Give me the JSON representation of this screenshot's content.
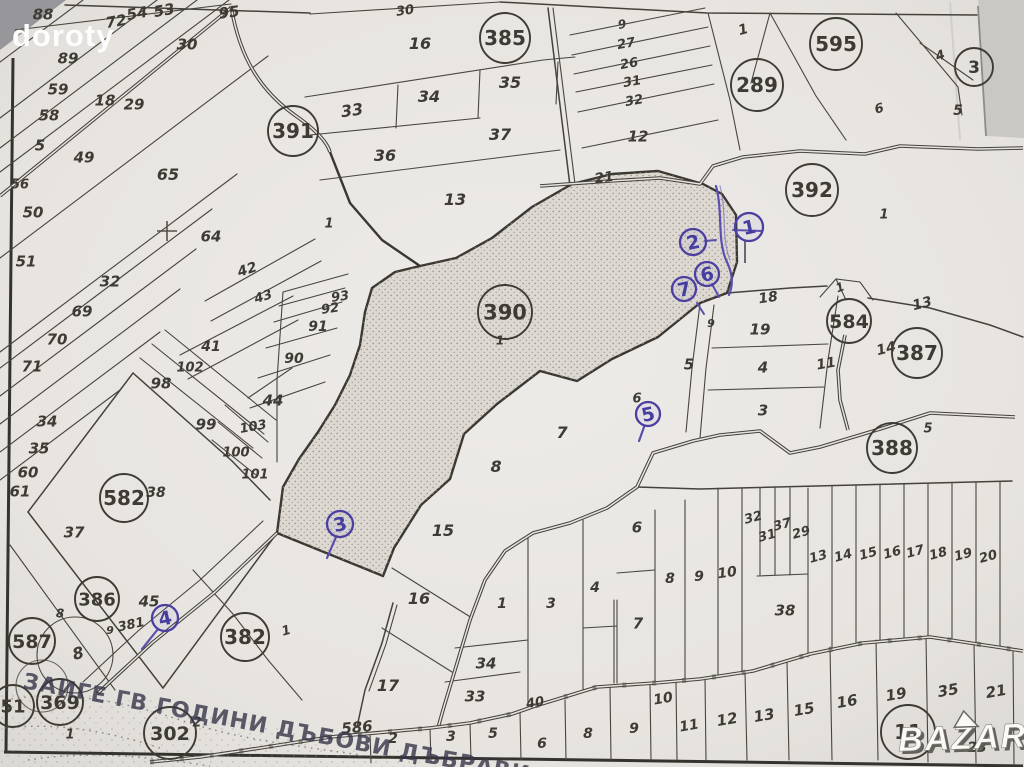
{
  "watermark": {
    "photographer": "doroty",
    "site": "BAZAR"
  },
  "handwriting": {
    "text": "ЗАИГЕ ГВ ГОДИНИ ДЪБОВИ ДЪБРАВИ"
  },
  "colors": {
    "paper": "#e9e6e2",
    "ink": "#3e3b34",
    "pen_blue": "#4c3f9f",
    "shade_fill": "#ddd9d2",
    "photo_gray": "#97969a"
  },
  "map_type": "cadastral-parcel-plan",
  "highlighted_parcel": "390",
  "pen_annotations": [
    "1",
    "2",
    "3",
    "4",
    "5",
    "6",
    "7"
  ],
  "labels": [
    {
      "t": "88",
      "x": 43,
      "y": 14,
      "k": "n"
    },
    {
      "t": "72",
      "x": 116,
      "y": 21,
      "k": "n",
      "rot": -10
    },
    {
      "t": "54",
      "x": 137,
      "y": 13,
      "k": "n",
      "rot": -10
    },
    {
      "t": "53",
      "x": 164,
      "y": 10,
      "k": "n",
      "rot": -10
    },
    {
      "t": "95",
      "x": 229,
      "y": 12,
      "k": "n",
      "rot": -8
    },
    {
      "t": "30",
      "x": 187,
      "y": 44,
      "k": "n"
    },
    {
      "t": "89",
      "x": 68,
      "y": 58,
      "k": "n"
    },
    {
      "t": "59",
      "x": 58,
      "y": 89,
      "k": "n"
    },
    {
      "t": "18",
      "x": 105,
      "y": 100,
      "k": "n"
    },
    {
      "t": "29",
      "x": 134,
      "y": 104,
      "k": "n"
    },
    {
      "t": "58",
      "x": 49,
      "y": 115,
      "k": "n"
    },
    {
      "t": "5",
      "x": 40,
      "y": 145,
      "k": "n"
    },
    {
      "t": "49",
      "x": 84,
      "y": 157,
      "k": "n"
    },
    {
      "t": "56",
      "x": 20,
      "y": 184,
      "k": "n",
      "fs": 13
    },
    {
      "t": "65",
      "x": 168,
      "y": 174,
      "k": "n",
      "fs": 16
    },
    {
      "t": "50",
      "x": 33,
      "y": 212,
      "k": "n"
    },
    {
      "t": "64",
      "x": 211,
      "y": 236,
      "k": "n"
    },
    {
      "t": "51",
      "x": 26,
      "y": 261,
      "k": "n"
    },
    {
      "t": "32",
      "x": 110,
      "y": 281,
      "k": "n"
    },
    {
      "t": "42",
      "x": 247,
      "y": 269,
      "k": "n",
      "rot": -18,
      "fs": 14
    },
    {
      "t": "43",
      "x": 263,
      "y": 296,
      "k": "n",
      "rot": -18,
      "fs": 13
    },
    {
      "t": "69",
      "x": 82,
      "y": 311,
      "k": "n"
    },
    {
      "t": "70",
      "x": 57,
      "y": 339,
      "k": "n"
    },
    {
      "t": "41",
      "x": 211,
      "y": 346,
      "k": "n",
      "fs": 14
    },
    {
      "t": "71",
      "x": 32,
      "y": 366,
      "k": "n"
    },
    {
      "t": "102",
      "x": 190,
      "y": 367,
      "k": "n",
      "fs": 13
    },
    {
      "t": "98",
      "x": 161,
      "y": 383,
      "k": "n"
    },
    {
      "t": "44",
      "x": 273,
      "y": 400,
      "k": "n"
    },
    {
      "t": "34",
      "x": 47,
      "y": 421,
      "k": "n"
    },
    {
      "t": "99",
      "x": 206,
      "y": 424,
      "k": "n"
    },
    {
      "t": "103",
      "x": 253,
      "y": 426,
      "k": "n",
      "rot": -10,
      "fs": 13
    },
    {
      "t": "35",
      "x": 39,
      "y": 448,
      "k": "n"
    },
    {
      "t": "100",
      "x": 236,
      "y": 452,
      "k": "n",
      "fs": 13
    },
    {
      "t": "60",
      "x": 28,
      "y": 472,
      "k": "n"
    },
    {
      "t": "101",
      "x": 255,
      "y": 474,
      "k": "n",
      "fs": 13
    },
    {
      "t": "61",
      "x": 20,
      "y": 491,
      "k": "n"
    },
    {
      "t": "582",
      "x": 124,
      "y": 498,
      "k": "c",
      "r": 24,
      "fs": 20
    },
    {
      "t": "38",
      "x": 156,
      "y": 492,
      "k": "n",
      "fs": 14
    },
    {
      "t": "37",
      "x": 74,
      "y": 532,
      "k": "n"
    },
    {
      "t": "386",
      "x": 97,
      "y": 599,
      "k": "c",
      "r": 22,
      "fs": 18
    },
    {
      "t": "45",
      "x": 149,
      "y": 601,
      "k": "n"
    },
    {
      "t": "8",
      "x": 60,
      "y": 613,
      "k": "n",
      "fs": 12
    },
    {
      "t": "381",
      "x": 131,
      "y": 624,
      "k": "n",
      "rot": -12,
      "fs": 13
    },
    {
      "t": "9",
      "x": 110,
      "y": 630,
      "k": "n",
      "fs": 11
    },
    {
      "t": "587",
      "x": 32,
      "y": 641,
      "k": "c",
      "r": 23,
      "fs": 19
    },
    {
      "t": "8",
      "x": 78,
      "y": 653,
      "k": "n",
      "fs": 16,
      "rot": -15
    },
    {
      "t": "382",
      "x": 245,
      "y": 637,
      "k": "c",
      "r": 24,
      "fs": 20
    },
    {
      "t": "1",
      "x": 286,
      "y": 630,
      "k": "n",
      "fs": 13,
      "rot": -15
    },
    {
      "t": "369",
      "x": 60,
      "y": 702,
      "k": "c",
      "r": 23,
      "fs": 19
    },
    {
      "t": "51",
      "x": 13,
      "y": 706,
      "k": "c",
      "r": 21,
      "fs": 18
    },
    {
      "t": "1",
      "x": 70,
      "y": 734,
      "k": "n",
      "fs": 13
    },
    {
      "t": "302",
      "x": 170,
      "y": 733,
      "k": "c",
      "r": 26,
      "fs": 19
    },
    {
      "t": "2",
      "x": 197,
      "y": 722,
      "k": "n",
      "fs": 13
    },
    {
      "t": "391",
      "x": 293,
      "y": 131,
      "k": "c",
      "r": 25,
      "fs": 20
    },
    {
      "t": "30",
      "x": 405,
      "y": 10,
      "k": "n",
      "fs": 13,
      "rot": -8
    },
    {
      "t": "16",
      "x": 420,
      "y": 43,
      "k": "n",
      "fs": 16
    },
    {
      "t": "385",
      "x": 505,
      "y": 38,
      "k": "c",
      "r": 25,
      "fs": 20
    },
    {
      "t": "33",
      "x": 352,
      "y": 110,
      "k": "n",
      "fs": 16,
      "rot": -8
    },
    {
      "t": "34",
      "x": 429,
      "y": 96,
      "k": "n",
      "fs": 16
    },
    {
      "t": "35",
      "x": 510,
      "y": 82,
      "k": "n",
      "fs": 16
    },
    {
      "t": "37",
      "x": 500,
      "y": 134,
      "k": "n",
      "fs": 16
    },
    {
      "t": "36",
      "x": 385,
      "y": 155,
      "k": "n",
      "fs": 16
    },
    {
      "t": "13",
      "x": 455,
      "y": 199,
      "k": "n",
      "fs": 16
    },
    {
      "t": "1",
      "x": 329,
      "y": 223,
      "k": "n",
      "fs": 13
    },
    {
      "t": "93",
      "x": 340,
      "y": 296,
      "k": "n",
      "fs": 13,
      "rot": -8
    },
    {
      "t": "92",
      "x": 330,
      "y": 308,
      "k": "n",
      "fs": 13,
      "rot": -8
    },
    {
      "t": "91",
      "x": 318,
      "y": 326,
      "k": "n",
      "fs": 14
    },
    {
      "t": "90",
      "x": 294,
      "y": 358,
      "k": "n",
      "fs": 14
    },
    {
      "t": "390",
      "x": 505,
      "y": 312,
      "k": "c",
      "r": 27,
      "fs": 21
    },
    {
      "t": "1",
      "x": 500,
      "y": 340,
      "k": "n",
      "fs": 12
    },
    {
      "t": "21",
      "x": 604,
      "y": 177,
      "k": "n",
      "fs": 14,
      "rot": -8
    },
    {
      "t": "9",
      "x": 622,
      "y": 24,
      "k": "n",
      "fs": 12,
      "rot": -10
    },
    {
      "t": "27",
      "x": 626,
      "y": 43,
      "k": "n",
      "fs": 13,
      "rot": -10
    },
    {
      "t": "26",
      "x": 629,
      "y": 63,
      "k": "n",
      "fs": 13,
      "rot": -10
    },
    {
      "t": "31",
      "x": 632,
      "y": 81,
      "k": "n",
      "fs": 13,
      "rot": -10
    },
    {
      "t": "32",
      "x": 634,
      "y": 100,
      "k": "n",
      "fs": 13,
      "rot": -10
    },
    {
      "t": "12",
      "x": 638,
      "y": 136,
      "k": "n",
      "fs": 15
    },
    {
      "t": "1",
      "x": 743,
      "y": 29,
      "k": "n",
      "fs": 14,
      "rot": -15
    },
    {
      "t": "595",
      "x": 836,
      "y": 44,
      "k": "c",
      "r": 26,
      "fs": 20
    },
    {
      "t": "289",
      "x": 757,
      "y": 85,
      "k": "c",
      "r": 26,
      "fs": 20
    },
    {
      "t": "4",
      "x": 940,
      "y": 55,
      "k": "n",
      "fs": 13,
      "rot": -20
    },
    {
      "t": "3",
      "x": 974,
      "y": 67,
      "k": "c",
      "r": 19,
      "fs": 17
    },
    {
      "t": "6",
      "x": 879,
      "y": 108,
      "k": "n",
      "fs": 13,
      "rot": -15
    },
    {
      "t": "5",
      "x": 958,
      "y": 110,
      "k": "n",
      "fs": 14
    },
    {
      "t": "392",
      "x": 812,
      "y": 190,
      "k": "c",
      "r": 26,
      "fs": 20
    },
    {
      "t": "1",
      "x": 884,
      "y": 214,
      "k": "n",
      "fs": 13
    },
    {
      "t": "18",
      "x": 768,
      "y": 297,
      "k": "n",
      "fs": 14,
      "rot": -8
    },
    {
      "t": "13",
      "x": 922,
      "y": 303,
      "k": "n",
      "fs": 14,
      "rot": -14
    },
    {
      "t": "1",
      "x": 840,
      "y": 287,
      "k": "n",
      "fs": 12,
      "rot": -20
    },
    {
      "t": "584",
      "x": 849,
      "y": 321,
      "k": "c",
      "r": 22,
      "fs": 19
    },
    {
      "t": "19",
      "x": 760,
      "y": 329,
      "k": "n",
      "fs": 15
    },
    {
      "t": "9",
      "x": 711,
      "y": 323,
      "k": "n",
      "fs": 11
    },
    {
      "t": "14",
      "x": 886,
      "y": 348,
      "k": "n",
      "fs": 14,
      "rot": -14
    },
    {
      "t": "387",
      "x": 917,
      "y": 353,
      "k": "c",
      "r": 25,
      "fs": 20
    },
    {
      "t": "5",
      "x": 689,
      "y": 364,
      "k": "n",
      "fs": 15
    },
    {
      "t": "4",
      "x": 763,
      "y": 367,
      "k": "n",
      "fs": 15
    },
    {
      "t": "11",
      "x": 826,
      "y": 363,
      "k": "n",
      "fs": 14,
      "rot": -10
    },
    {
      "t": "3",
      "x": 763,
      "y": 410,
      "k": "n",
      "fs": 15
    },
    {
      "t": "6",
      "x": 637,
      "y": 398,
      "k": "n",
      "fs": 13
    },
    {
      "t": "388",
      "x": 892,
      "y": 448,
      "k": "c",
      "r": 25,
      "fs": 20
    },
    {
      "t": "5",
      "x": 928,
      "y": 428,
      "k": "n",
      "fs": 13
    },
    {
      "t": "7",
      "x": 562,
      "y": 432,
      "k": "n",
      "fs": 16
    },
    {
      "t": "8",
      "x": 496,
      "y": 466,
      "k": "n",
      "fs": 16
    },
    {
      "t": "15",
      "x": 443,
      "y": 530,
      "k": "n",
      "fs": 16
    },
    {
      "t": "6",
      "x": 637,
      "y": 527,
      "k": "n",
      "fs": 15
    },
    {
      "t": "32",
      "x": 753,
      "y": 517,
      "k": "n",
      "fs": 13,
      "rot": -15
    },
    {
      "t": "31",
      "x": 767,
      "y": 535,
      "k": "n",
      "fs": 13,
      "rot": -15
    },
    {
      "t": "37",
      "x": 782,
      "y": 524,
      "k": "n",
      "fs": 13,
      "rot": -15
    },
    {
      "t": "29",
      "x": 801,
      "y": 532,
      "k": "n",
      "fs": 13,
      "rot": -15
    },
    {
      "t": "8",
      "x": 670,
      "y": 578,
      "k": "n",
      "fs": 14
    },
    {
      "t": "9",
      "x": 699,
      "y": 576,
      "k": "n",
      "fs": 14
    },
    {
      "t": "10",
      "x": 727,
      "y": 572,
      "k": "n",
      "fs": 14,
      "rot": -8
    },
    {
      "t": "13",
      "x": 818,
      "y": 556,
      "k": "n",
      "fs": 13,
      "rot": -15
    },
    {
      "t": "14",
      "x": 843,
      "y": 555,
      "k": "n",
      "fs": 13,
      "rot": -15
    },
    {
      "t": "15",
      "x": 868,
      "y": 553,
      "k": "n",
      "fs": 13,
      "rot": -15
    },
    {
      "t": "16",
      "x": 892,
      "y": 552,
      "k": "n",
      "fs": 13,
      "rot": -15
    },
    {
      "t": "17",
      "x": 915,
      "y": 551,
      "k": "n",
      "fs": 13,
      "rot": -15
    },
    {
      "t": "18",
      "x": 938,
      "y": 553,
      "k": "n",
      "fs": 13,
      "rot": -15
    },
    {
      "t": "19",
      "x": 963,
      "y": 554,
      "k": "n",
      "fs": 13,
      "rot": -15
    },
    {
      "t": "20",
      "x": 988,
      "y": 556,
      "k": "n",
      "fs": 13,
      "rot": -15
    },
    {
      "t": "38",
      "x": 785,
      "y": 610,
      "k": "n",
      "fs": 15
    },
    {
      "t": "16",
      "x": 419,
      "y": 598,
      "k": "n",
      "fs": 16
    },
    {
      "t": "1",
      "x": 502,
      "y": 603,
      "k": "n",
      "fs": 14
    },
    {
      "t": "3",
      "x": 551,
      "y": 603,
      "k": "n",
      "fs": 14
    },
    {
      "t": "4",
      "x": 595,
      "y": 587,
      "k": "n",
      "fs": 14
    },
    {
      "t": "7",
      "x": 638,
      "y": 623,
      "k": "n",
      "fs": 15
    },
    {
      "t": "17",
      "x": 388,
      "y": 685,
      "k": "n",
      "fs": 16
    },
    {
      "t": "34",
      "x": 486,
      "y": 663,
      "k": "n",
      "fs": 15
    },
    {
      "t": "33",
      "x": 475,
      "y": 696,
      "k": "n",
      "fs": 15
    },
    {
      "t": "586",
      "x": 357,
      "y": 727,
      "k": "n",
      "fs": 15,
      "rot": -5
    },
    {
      "t": "40",
      "x": 535,
      "y": 702,
      "k": "n",
      "fs": 13,
      "rot": -10
    },
    {
      "t": "2",
      "x": 393,
      "y": 738,
      "k": "n",
      "fs": 14
    },
    {
      "t": "3",
      "x": 451,
      "y": 736,
      "k": "n",
      "fs": 14
    },
    {
      "t": "5",
      "x": 493,
      "y": 733,
      "k": "n",
      "fs": 14
    },
    {
      "t": "6",
      "x": 542,
      "y": 743,
      "k": "n",
      "fs": 14
    },
    {
      "t": "8",
      "x": 588,
      "y": 733,
      "k": "n",
      "fs": 14
    },
    {
      "t": "9",
      "x": 634,
      "y": 728,
      "k": "n",
      "fs": 14
    },
    {
      "t": "10",
      "x": 663,
      "y": 698,
      "k": "n",
      "fs": 14,
      "rot": -10
    },
    {
      "t": "11",
      "x": 689,
      "y": 725,
      "k": "n",
      "fs": 14,
      "rot": -10
    },
    {
      "t": "12",
      "x": 727,
      "y": 719,
      "k": "n",
      "fs": 15,
      "rot": -10
    },
    {
      "t": "13",
      "x": 764,
      "y": 715,
      "k": "n",
      "fs": 15,
      "rot": -10
    },
    {
      "t": "15",
      "x": 804,
      "y": 709,
      "k": "n",
      "fs": 15,
      "rot": -10
    },
    {
      "t": "16",
      "x": 847,
      "y": 701,
      "k": "n",
      "fs": 15,
      "rot": -10
    },
    {
      "t": "19",
      "x": 896,
      "y": 694,
      "k": "n",
      "fs": 15,
      "rot": -10
    },
    {
      "t": "35",
      "x": 948,
      "y": 690,
      "k": "n",
      "fs": 15,
      "rot": -10
    },
    {
      "t": "21",
      "x": 996,
      "y": 691,
      "k": "n",
      "fs": 15,
      "rot": -10
    },
    {
      "t": "11",
      "x": 908,
      "y": 732,
      "k": "c",
      "r": 27,
      "fs": 20
    },
    {
      "t": "23",
      "x": 977,
      "y": 747,
      "k": "n",
      "fs": 14
    },
    {
      "t": "1",
      "x": 749,
      "y": 227,
      "k": "b",
      "r": 14
    },
    {
      "t": "2",
      "x": 693,
      "y": 242,
      "k": "b",
      "r": 13
    },
    {
      "t": "6",
      "x": 707,
      "y": 274,
      "k": "b",
      "r": 12
    },
    {
      "t": "7",
      "x": 684,
      "y": 289,
      "k": "b",
      "r": 12
    },
    {
      "t": "5",
      "x": 648,
      "y": 414,
      "k": "b",
      "r": 12
    },
    {
      "t": "3",
      "x": 340,
      "y": 524,
      "k": "b",
      "r": 13
    },
    {
      "t": "4",
      "x": 165,
      "y": 618,
      "k": "b",
      "r": 13
    }
  ]
}
